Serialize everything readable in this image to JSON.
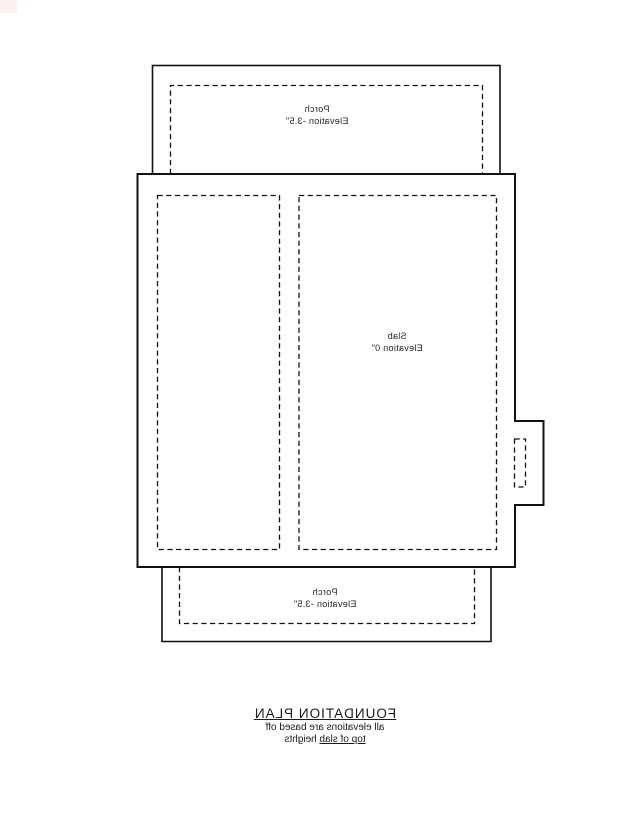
{
  "presentation": {
    "text_mirrored": true
  },
  "colors": {
    "background": "#ffffff",
    "line": "#111111",
    "text": "#222222",
    "corner_artifact": "#fbf1f1"
  },
  "regions": {
    "top_porch": {
      "name": "Porch",
      "elevation": "Elevation -3.5\""
    },
    "slab": {
      "name": "Slab",
      "elevation": "Elevation 0\""
    },
    "bottom_porch": {
      "name": "Porch",
      "elevation": "Elevation -3.5\""
    }
  },
  "title_block": {
    "title": "FOUNDATION PLAN",
    "note_line1": "all elevations are based off",
    "note_line2_underlined": "top of slab",
    "note_line2_rest": " heights"
  }
}
